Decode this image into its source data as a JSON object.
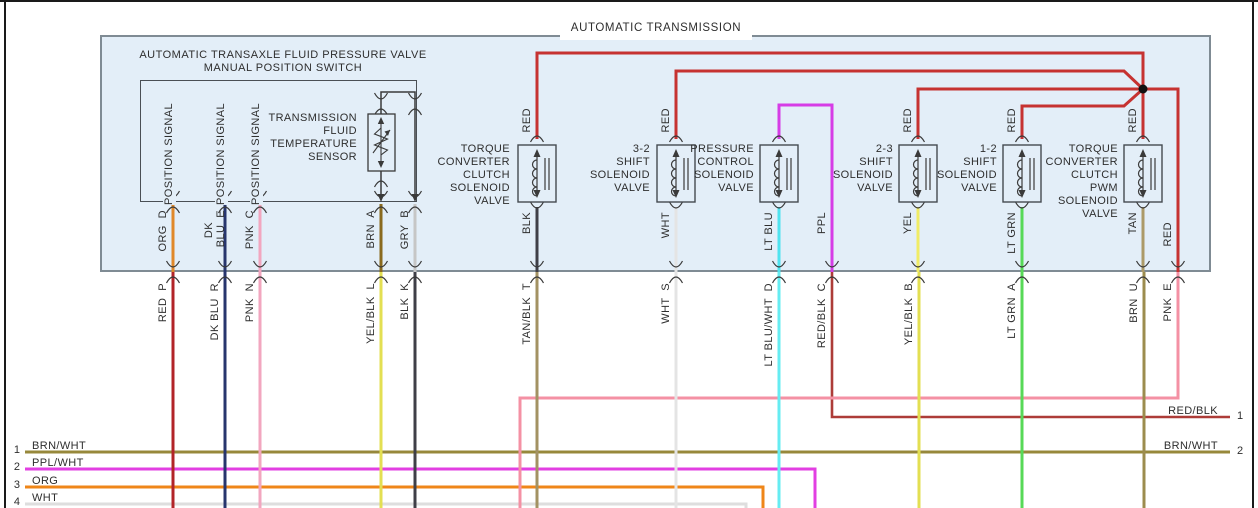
{
  "diagram_title": "AUTOMATIC TRANSMISSION",
  "panel_caption": {
    "line1": "AUTOMATIC TRANSAXLE FLUID PRESSURE VALVE",
    "line2": "MANUAL POSITION SWITCH"
  },
  "colors": {
    "panel_fill": "#e3eef8",
    "panel_border": "#7f8b94",
    "frame": "#1a1a1a",
    "text": "#2e2e2e",
    "wire_black": "#3a3a3a",
    "red": "#c63231",
    "red_p": "#b22428",
    "org": "#e0882a",
    "dk_blu": "#27356d",
    "pnk": "#f2a6bf",
    "brn": "#8a6a1e",
    "gry": "#c6c6c6",
    "blk": "#3f3f47",
    "wht": "#e4e4e4",
    "lt_blu": "#4fe3ef",
    "ppl": "#d63ce6",
    "yel": "#f0ec66",
    "lt_grn": "#57d957",
    "tan": "#ac9a68",
    "yel_blk": "#e3df52",
    "tan_blk": "#a39263",
    "lt_blu_wht": "#66ecf2",
    "red_blk": "#ad3c38",
    "brn_wht_v": "#9c8c4e",
    "pnk_e": "#f491a4",
    "brn_wht": "#97883b",
    "ppl_wht": "#e23fe2",
    "org_btm": "#ef8618",
    "wht_btm": "#dedede"
  },
  "sensor": {
    "label_lines": [
      "TRANSMISSION",
      "FLUID",
      "TEMPERATURE",
      "SENSOR"
    ]
  },
  "position_signal_labels": [
    {
      "text": "POSITION SIGNAL",
      "x": 163,
      "y": 103
    },
    {
      "text": "POSITION SIGNAL",
      "x": 215,
      "y": 103
    },
    {
      "text": "POSITION SIGNAL",
      "x": 250,
      "y": 103
    }
  ],
  "solenoids": [
    {
      "id": "tcc",
      "x": 537,
      "lines": [
        "TORQUE",
        "CONVERTER",
        "CLUTCH",
        "SOLENOID",
        "VALVE"
      ],
      "label_right": 748
    },
    {
      "id": "3-2-shift",
      "x": 676,
      "lines": [
        "3-2",
        "SHIFT",
        "SOLENOID",
        "VALVE"
      ],
      "label_right": 608
    },
    {
      "id": "pressure-control",
      "x": 779,
      "lines": [
        "PRESSURE",
        "CONTROL",
        "SOLENOID",
        "VALVE"
      ],
      "label_right": 504
    },
    {
      "id": "2-3-shift",
      "x": 918,
      "lines": [
        "2-3",
        "SHIFT",
        "SOLENOID",
        "VALVE"
      ],
      "label_right": 365
    },
    {
      "id": "1-2-shift",
      "x": 1022,
      "lines": [
        "1-2",
        "SHIFT",
        "SOLENOID",
        "VALVE"
      ],
      "label_right": 261
    },
    {
      "id": "tcc-pwm",
      "x": 1143,
      "lines": [
        "TORQUE",
        "CONVERTER",
        "CLUTCH",
        "PWM",
        "SOLENOID",
        "VALVE"
      ],
      "label_right": 140
    }
  ],
  "wires": [
    {
      "name": "brn-wht-1",
      "color": "brn_wht",
      "w": 3,
      "pts": [
        [
          25,
          452
        ],
        [
          1230,
          452
        ]
      ]
    },
    {
      "name": "ppl-wht-2",
      "color": "ppl_wht",
      "w": 3,
      "pts": [
        [
          25,
          469
        ],
        [
          815,
          469
        ],
        [
          815,
          508
        ]
      ]
    },
    {
      "name": "org-3",
      "color": "org_btm",
      "w": 3,
      "pts": [
        [
          25,
          487
        ],
        [
          763,
          487
        ],
        [
          763,
          508
        ]
      ]
    },
    {
      "name": "wht-4",
      "color": "wht_btm",
      "w": 3,
      "pts": [
        [
          25,
          504
        ],
        [
          746,
          504
        ],
        [
          746,
          508
        ]
      ]
    },
    {
      "name": "red-blk-c",
      "color": "red_blk",
      "w": 2.6,
      "pts": [
        [
          832,
          272
        ],
        [
          832,
          417
        ],
        [
          1230,
          417
        ]
      ]
    },
    {
      "name": "pnk-e",
      "color": "pnk_e",
      "w": 3,
      "pts": [
        [
          1178,
          272
        ],
        [
          1178,
          398
        ],
        [
          520,
          398
        ],
        [
          520,
          508
        ]
      ]
    },
    {
      "name": "red-p",
      "color": "red_p",
      "w": 3,
      "pts": [
        [
          173,
          272
        ],
        [
          173,
          508
        ]
      ]
    },
    {
      "name": "dk-blu-r",
      "color": "dk_blu",
      "w": 3,
      "pts": [
        [
          225,
          272
        ],
        [
          225,
          508
        ]
      ]
    },
    {
      "name": "pnk-n",
      "color": "pnk",
      "w": 3,
      "pts": [
        [
          260,
          272
        ],
        [
          260,
          508
        ]
      ]
    },
    {
      "name": "yel-blk-l",
      "color": "yel_blk",
      "w": 3,
      "pts": [
        [
          381,
          272
        ],
        [
          381,
          508
        ]
      ]
    },
    {
      "name": "blk-k",
      "color": "blk",
      "w": 3,
      "pts": [
        [
          415,
          272
        ],
        [
          415,
          508
        ]
      ]
    },
    {
      "name": "tan-blk-t",
      "color": "tan_blk",
      "w": 3,
      "pts": [
        [
          537,
          272
        ],
        [
          537,
          508
        ]
      ]
    },
    {
      "name": "wht-s",
      "color": "wht",
      "w": 3,
      "pts": [
        [
          676,
          272
        ],
        [
          676,
          508
        ]
      ]
    },
    {
      "name": "lt-blu-wht-d",
      "color": "lt_blu_wht",
      "w": 3,
      "pts": [
        [
          779,
          272
        ],
        [
          779,
          508
        ]
      ]
    },
    {
      "name": "yel-blk-b",
      "color": "yel_blk",
      "w": 3,
      "pts": [
        [
          919,
          272
        ],
        [
          919,
          508
        ]
      ]
    },
    {
      "name": "lt-grn-a",
      "color": "lt_grn",
      "w": 3,
      "pts": [
        [
          1022,
          272
        ],
        [
          1022,
          508
        ]
      ]
    },
    {
      "name": "brn-u",
      "color": "brn_wht_v",
      "w": 3,
      "pts": [
        [
          1144,
          272
        ],
        [
          1144,
          508
        ]
      ]
    },
    {
      "name": "org-d",
      "color": "org",
      "w": 3,
      "pts": [
        [
          173,
          204
        ],
        [
          173,
          272
        ]
      ]
    },
    {
      "name": "dk-blu-e",
      "color": "dk_blu",
      "w": 3,
      "pts": [
        [
          225,
          204
        ],
        [
          225,
          272
        ]
      ]
    },
    {
      "name": "pnk-c",
      "color": "pnk",
      "w": 3,
      "pts": [
        [
          260,
          204
        ],
        [
          260,
          272
        ]
      ]
    },
    {
      "name": "brn-a",
      "color": "brn",
      "w": 3,
      "pts": [
        [
          381,
          204
        ],
        [
          381,
          272
        ]
      ]
    },
    {
      "name": "gry-b",
      "color": "gry",
      "w": 3,
      "pts": [
        [
          415,
          204
        ],
        [
          415,
          272
        ]
      ]
    },
    {
      "name": "blk-tcc",
      "color": "blk",
      "w": 3,
      "pts": [
        [
          537,
          207
        ],
        [
          537,
          272
        ]
      ]
    },
    {
      "name": "wht-32",
      "color": "wht",
      "w": 3,
      "pts": [
        [
          676,
          207
        ],
        [
          676,
          272
        ]
      ]
    },
    {
      "name": "lt-blu-pc",
      "color": "lt_blu",
      "w": 3,
      "pts": [
        [
          779,
          207
        ],
        [
          779,
          272
        ]
      ]
    },
    {
      "name": "yel-23",
      "color": "yel",
      "w": 3,
      "pts": [
        [
          918,
          207
        ],
        [
          918,
          272
        ]
      ]
    },
    {
      "name": "lt-grn-12",
      "color": "lt_grn",
      "w": 3,
      "pts": [
        [
          1022,
          207
        ],
        [
          1022,
          272
        ]
      ]
    },
    {
      "name": "tan-pwm",
      "color": "tan",
      "w": 3,
      "pts": [
        [
          1143,
          207
        ],
        [
          1143,
          272
        ]
      ]
    },
    {
      "name": "red-feed-tcc",
      "color": "red",
      "w": 3,
      "pts": [
        [
          537,
          139
        ],
        [
          537,
          53
        ],
        [
          1143,
          53
        ],
        [
          1143,
          89
        ]
      ]
    },
    {
      "name": "red-feed-3-2",
      "color": "red",
      "w": 3,
      "pts": [
        [
          676,
          139
        ],
        [
          676,
          71
        ],
        [
          1124,
          71
        ],
        [
          1143,
          89
        ]
      ]
    },
    {
      "name": "red-feed-2-3",
      "color": "red",
      "w": 3,
      "pts": [
        [
          918,
          139
        ],
        [
          918,
          89
        ],
        [
          1143,
          89
        ]
      ]
    },
    {
      "name": "red-feed-1-2",
      "color": "red",
      "w": 3,
      "pts": [
        [
          1022,
          139
        ],
        [
          1022,
          106
        ],
        [
          1124,
          106
        ],
        [
          1143,
          89
        ]
      ]
    },
    {
      "name": "red-feed-tcc-pwm",
      "color": "red",
      "w": 3,
      "pts": [
        [
          1143,
          139
        ],
        [
          1143,
          89
        ]
      ]
    },
    {
      "name": "red-branch-right",
      "color": "red",
      "w": 3,
      "pts": [
        [
          1143,
          89
        ],
        [
          1178,
          89
        ],
        [
          1178,
          272
        ]
      ]
    },
    {
      "name": "ppl-feed",
      "color": "ppl",
      "w": 3,
      "pts": [
        [
          779,
          139
        ],
        [
          779,
          105
        ],
        [
          832,
          105
        ],
        [
          832,
          272
        ]
      ]
    },
    {
      "name": "sensor-loop",
      "color": "wire_black",
      "w": 1.5,
      "pts": [
        [
          381,
          114
        ],
        [
          381,
          92
        ],
        [
          415,
          92
        ],
        [
          415,
          199
        ]
      ]
    },
    {
      "name": "sensor-bottom",
      "color": "wire_black",
      "w": 1.5,
      "pts": [
        [
          381,
          171
        ],
        [
          381,
          199
        ]
      ]
    }
  ],
  "junction_dot": {
    "x": 1143,
    "y": 89,
    "r": 4.5
  },
  "connectors": [
    {
      "x": 173,
      "y": 202,
      "t": "pair"
    },
    {
      "x": 225,
      "y": 202,
      "t": "pair"
    },
    {
      "x": 260,
      "y": 202,
      "t": "pair"
    },
    {
      "x": 381,
      "y": 202,
      "t": "pair"
    },
    {
      "x": 415,
      "y": 202,
      "t": "pair"
    },
    {
      "x": 381,
      "y": 104,
      "t": "pair"
    },
    {
      "x": 415,
      "y": 104,
      "t": "pair"
    },
    {
      "x": 381,
      "y": 176,
      "t": "pair"
    },
    {
      "x": 537,
      "y": 133,
      "t": "n"
    },
    {
      "x": 676,
      "y": 133,
      "t": "n"
    },
    {
      "x": 779,
      "y": 133,
      "t": "n"
    },
    {
      "x": 918,
      "y": 133,
      "t": "n"
    },
    {
      "x": 1022,
      "y": 133,
      "t": "n"
    },
    {
      "x": 1143,
      "y": 133,
      "t": "n"
    },
    {
      "x": 537,
      "y": 211,
      "t": "u"
    },
    {
      "x": 676,
      "y": 211,
      "t": "u"
    },
    {
      "x": 779,
      "y": 211,
      "t": "u"
    },
    {
      "x": 918,
      "y": 211,
      "t": "u"
    },
    {
      "x": 1022,
      "y": 211,
      "t": "u"
    },
    {
      "x": 1143,
      "y": 211,
      "t": "u"
    },
    {
      "x": 173,
      "y": 272,
      "t": "pair"
    },
    {
      "x": 225,
      "y": 272,
      "t": "pair"
    },
    {
      "x": 260,
      "y": 272,
      "t": "pair"
    },
    {
      "x": 381,
      "y": 272,
      "t": "pair"
    },
    {
      "x": 415,
      "y": 272,
      "t": "pair"
    },
    {
      "x": 537,
      "y": 272,
      "t": "pair"
    },
    {
      "x": 676,
      "y": 272,
      "t": "pair"
    },
    {
      "x": 779,
      "y": 272,
      "t": "pair"
    },
    {
      "x": 832,
      "y": 272,
      "t": "pair"
    },
    {
      "x": 918,
      "y": 272,
      "t": "pair"
    },
    {
      "x": 1022,
      "y": 272,
      "t": "pair"
    },
    {
      "x": 1143,
      "y": 272,
      "t": "pair"
    },
    {
      "x": 1178,
      "y": 272,
      "t": "pair"
    }
  ],
  "arrows": [
    {
      "x": 381,
      "y": 200
    },
    {
      "x": 415,
      "y": 200
    }
  ],
  "wire_vlabels": [
    {
      "text": "ORG  D",
      "x": 157,
      "y": 210
    },
    {
      "text": "DK",
      "x": 203,
      "y": 222
    },
    {
      "text": "BLU  E",
      "x": 215,
      "y": 210
    },
    {
      "text": "PNK  C",
      "x": 244,
      "y": 210
    },
    {
      "text": "BRN  A",
      "x": 365,
      "y": 210
    },
    {
      "text": "GRY  B",
      "x": 399,
      "y": 210
    },
    {
      "text": "BLK",
      "x": 521,
      "y": 212
    },
    {
      "text": "WHT",
      "x": 660,
      "y": 212
    },
    {
      "text": "LT BLU",
      "x": 763,
      "y": 212
    },
    {
      "text": "PPL",
      "x": 816,
      "y": 212
    },
    {
      "text": "YEL",
      "x": 902,
      "y": 212
    },
    {
      "text": "LT GRN",
      "x": 1006,
      "y": 212
    },
    {
      "text": "TAN",
      "x": 1127,
      "y": 212
    },
    {
      "text": "RED",
      "x": 1162,
      "y": 222
    },
    {
      "text": "RED",
      "x": 521,
      "y": 108
    },
    {
      "text": "RED",
      "x": 660,
      "y": 108
    },
    {
      "text": "RED",
      "x": 902,
      "y": 108
    },
    {
      "text": "RED",
      "x": 1006,
      "y": 108
    },
    {
      "text": "RED",
      "x": 1127,
      "y": 108
    },
    {
      "text": "RED  P",
      "x": 157,
      "y": 283
    },
    {
      "text": "DK BLU  R",
      "x": 209,
      "y": 283
    },
    {
      "text": "PNK  N",
      "x": 244,
      "y": 283
    },
    {
      "text": "YEL/BLK  L",
      "x": 365,
      "y": 283
    },
    {
      "text": "BLK  K",
      "x": 399,
      "y": 283
    },
    {
      "text": "TAN/BLK  T",
      "x": 521,
      "y": 283
    },
    {
      "text": "WHT  S",
      "x": 660,
      "y": 283
    },
    {
      "text": "LT BLU/WHT  D",
      "x": 763,
      "y": 283
    },
    {
      "text": "RED/BLK  C",
      "x": 816,
      "y": 283
    },
    {
      "text": "YEL/BLK  B",
      "x": 903,
      "y": 283
    },
    {
      "text": "LT GRN  A",
      "x": 1006,
      "y": 283
    },
    {
      "text": "BRN  U",
      "x": 1128,
      "y": 283
    },
    {
      "text": "PNK  E",
      "x": 1162,
      "y": 283
    }
  ],
  "bottom_left_wires": [
    {
      "num": "1",
      "label": "BRN/WHT",
      "num_y": 444,
      "label_y": 440
    },
    {
      "num": "2",
      "label": "PPL/WHT",
      "num_y": 461,
      "label_y": 457
    },
    {
      "num": "3",
      "label": "ORG",
      "num_y": 479,
      "label_y": 475
    },
    {
      "num": "4",
      "label": "WHT",
      "num_y": 496,
      "label_y": 492
    }
  ],
  "bottom_right_wires": [
    {
      "num": "1",
      "label": "RED/BLK",
      "num_y": 410,
      "label_y": 405
    },
    {
      "num": "2",
      "label": "BRN/WHT",
      "num_y": 445,
      "label_y": 440
    }
  ]
}
